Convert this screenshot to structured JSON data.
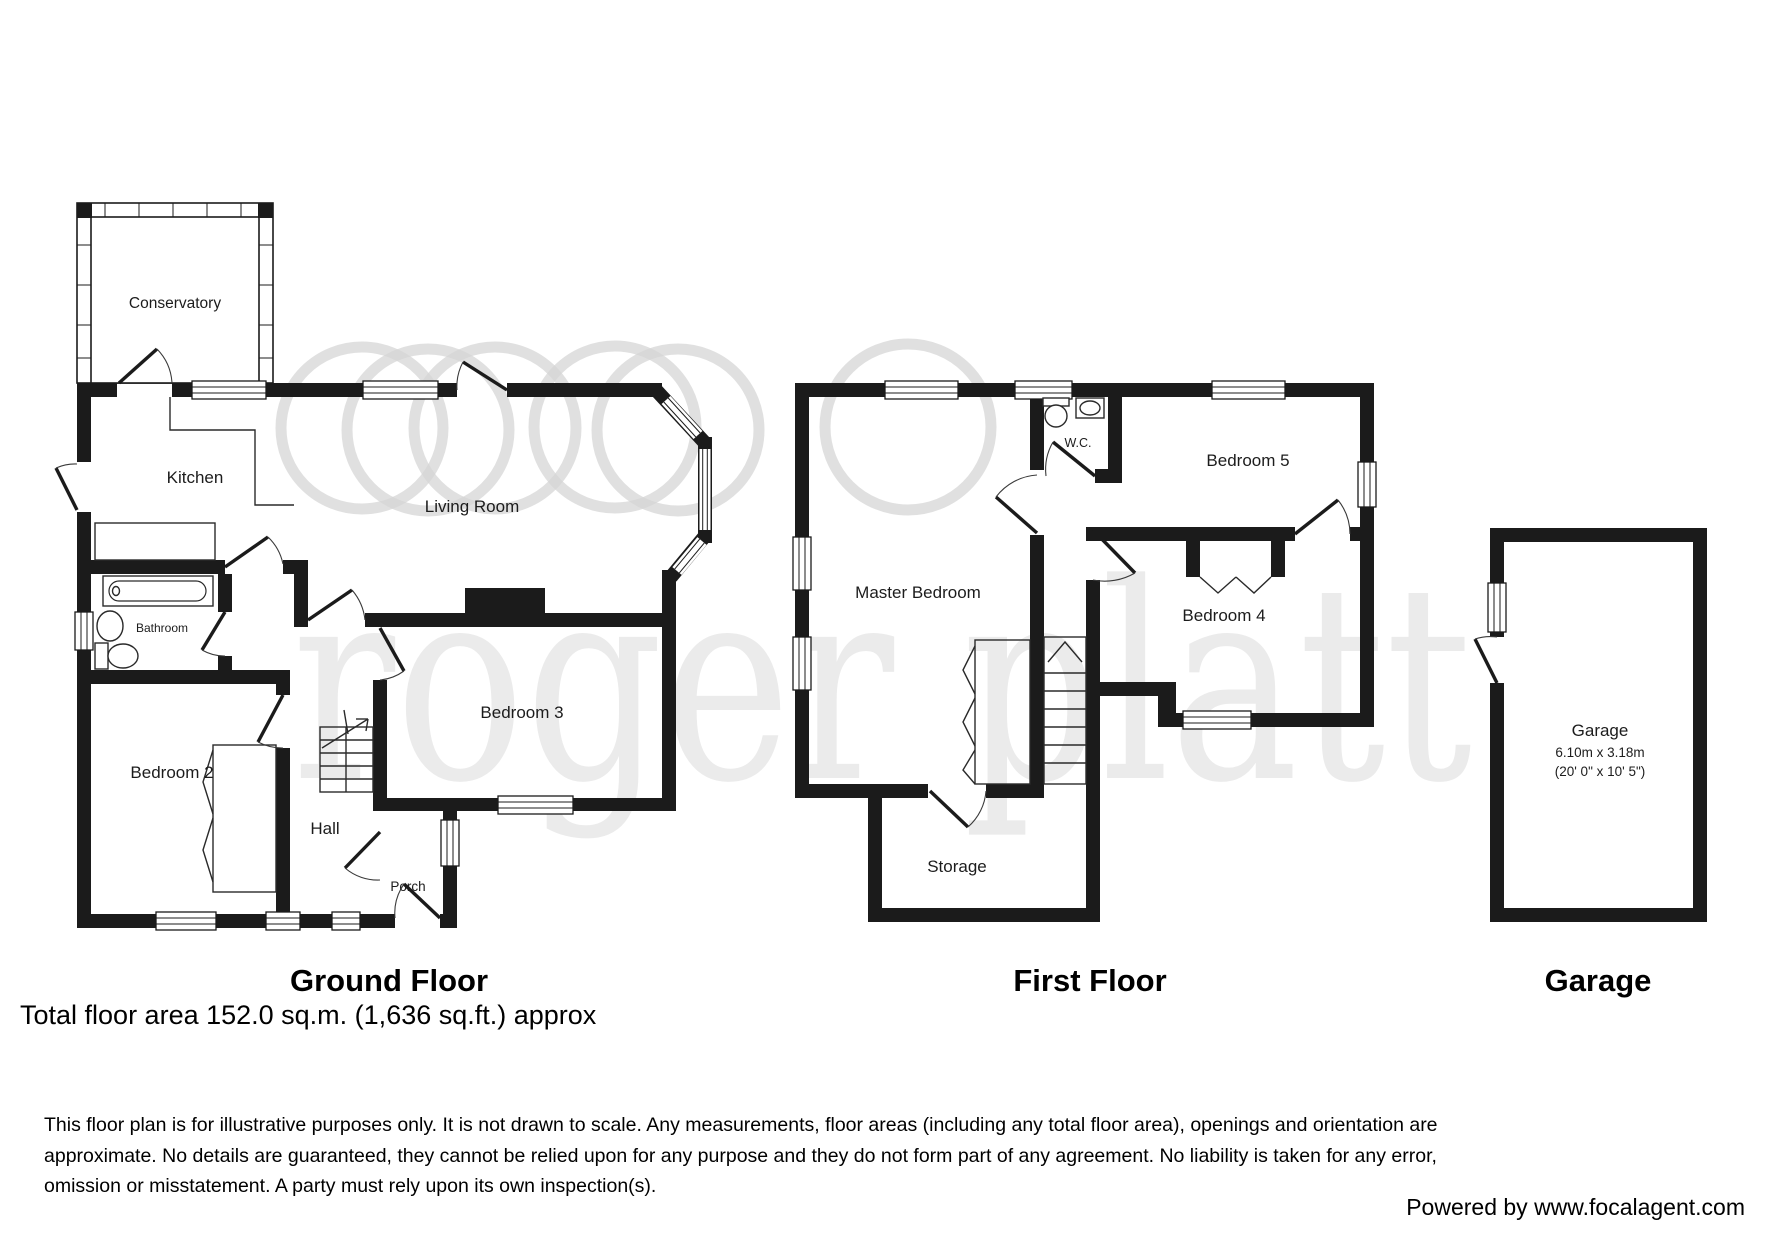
{
  "watermark": {
    "text": "roger platt"
  },
  "ground_floor": {
    "title": "Ground Floor",
    "rooms": [
      {
        "label": "Conservatory"
      },
      {
        "label": "Kitchen"
      },
      {
        "label": "Living Room"
      },
      {
        "label": "Bathroom"
      },
      {
        "label": "Bedroom 2"
      },
      {
        "label": "Bedroom 3"
      },
      {
        "label": "Hall"
      },
      {
        "label": "Porch"
      }
    ]
  },
  "first_floor": {
    "title": "First Floor",
    "rooms": [
      {
        "label": "W.C."
      },
      {
        "label": "Bedroom 5"
      },
      {
        "label": "Master Bedroom"
      },
      {
        "label": "Bedroom 4"
      },
      {
        "label": "Storage"
      }
    ]
  },
  "garage": {
    "title": "Garage",
    "label": "Garage",
    "dim_metric": "6.10m x 3.18m",
    "dim_imperial": "(20' 0\" x 10' 5\")"
  },
  "footer": {
    "total_area": "Total floor area 152.0 sq.m. (1,636 sq.ft.) approx",
    "disclaimer_lines": [
      "This floor plan is for illustrative purposes only. It is not drawn to scale. Any measurements, floor areas (including any total floor area), openings and orientation are",
      "approximate. No details are guaranteed, they cannot be relied upon for any purpose and they do not form part of any agreement. No liability is taken for any error,",
      "omission or misstatement. A party must rely upon its own inspection(s)."
    ],
    "powered_by": "Powered by www.focalagent.com"
  }
}
